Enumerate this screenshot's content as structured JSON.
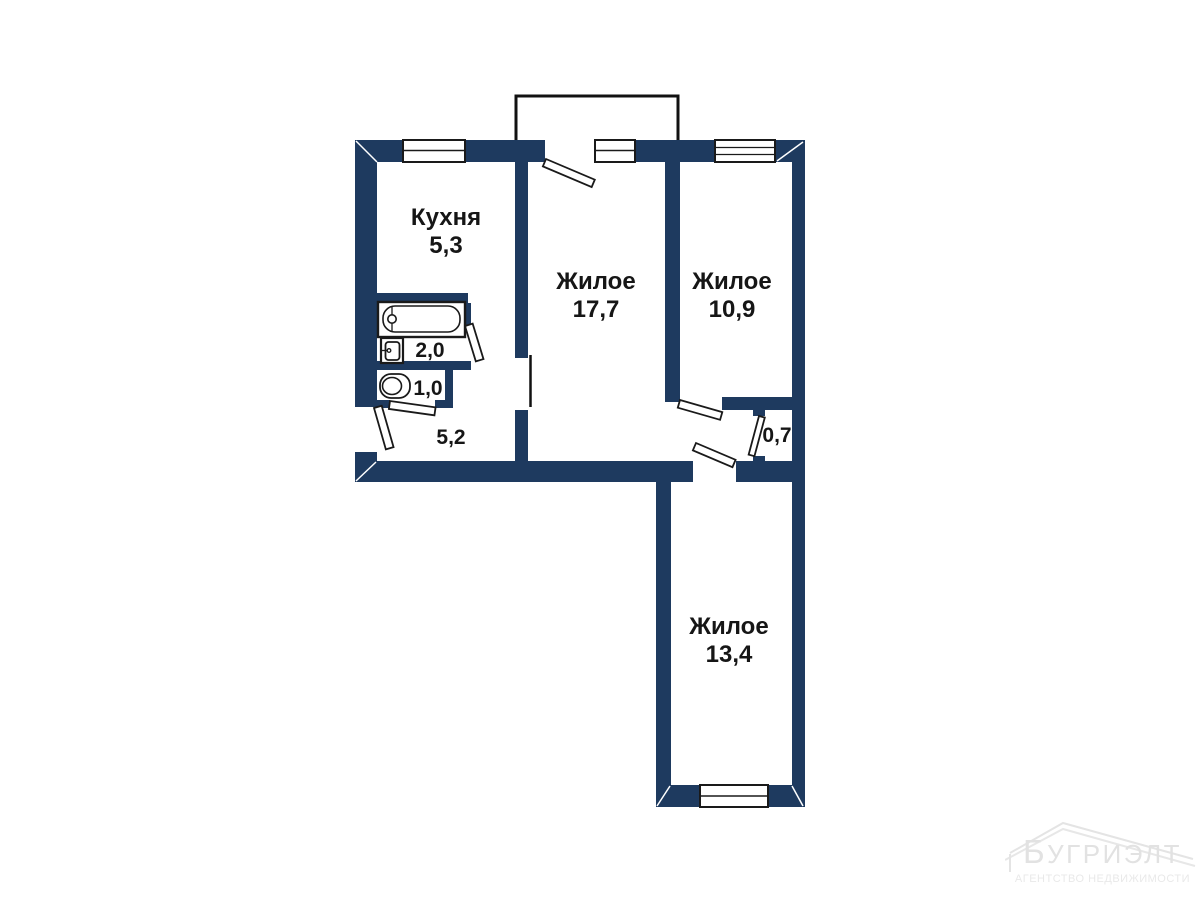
{
  "rooms": {
    "kitchen": {
      "name": "Кухня",
      "area": "5,3"
    },
    "living_main": {
      "name": "Жилое",
      "area": "17,7"
    },
    "living_right": {
      "name": "Жилое",
      "area": "10,9"
    },
    "living_bottom": {
      "name": "Жилое",
      "area": "13,4"
    },
    "hallway": {
      "area": "5,2"
    },
    "bathroom": {
      "area": "2,0"
    },
    "toilet": {
      "area": "1,0"
    },
    "closet": {
      "area": "0,7"
    }
  },
  "watermark": {
    "brand": "БУГРИЭЛТ",
    "tagline": "АГЕНТСТВО НЕДВИЖИМОСТИ"
  },
  "colors": {
    "wall": "#1e3a5f",
    "line": "#1a1a1a",
    "watermark": "#e4e4e4"
  }
}
